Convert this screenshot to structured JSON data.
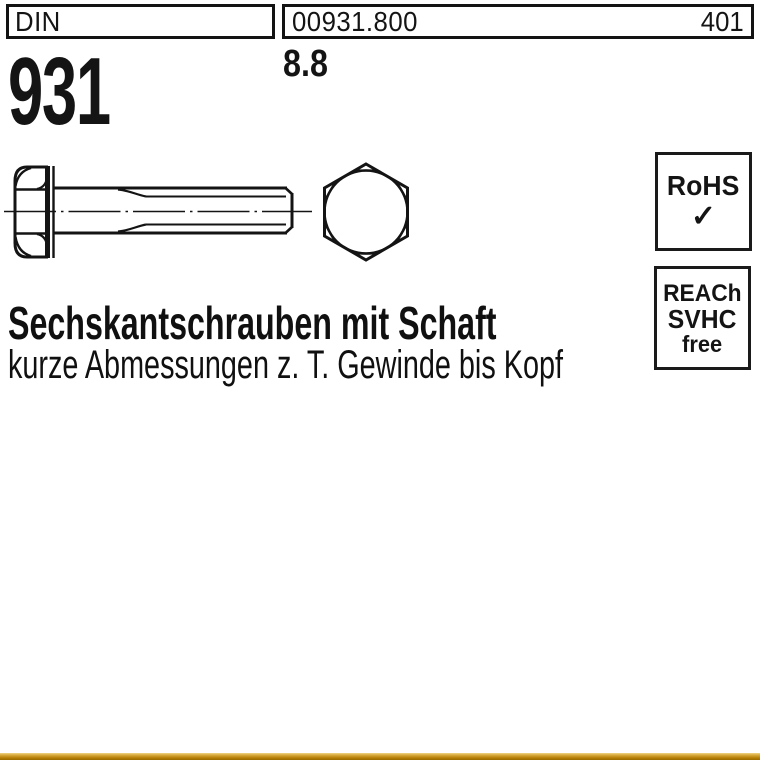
{
  "header": {
    "din_label": "DIN",
    "article_number": "00931.800",
    "page_number": "401",
    "standard_number": "931",
    "strength_class": "8.8"
  },
  "badges": {
    "rohs": {
      "label": "RoHS",
      "check": "✓"
    },
    "reach": {
      "line1": "REACh",
      "line2": "SVHC",
      "line3": "free"
    }
  },
  "title": {
    "heading": "Sechskantschrauben mit Schaft",
    "subtitle": "kurze Abmessungen z. T. Gewinde bis Kopf"
  },
  "drawing": {
    "description": "hex bolt side view with shank and thread, hex head front view",
    "line_color": "#141414"
  },
  "footer": {
    "bar_color": "#c98f12"
  }
}
